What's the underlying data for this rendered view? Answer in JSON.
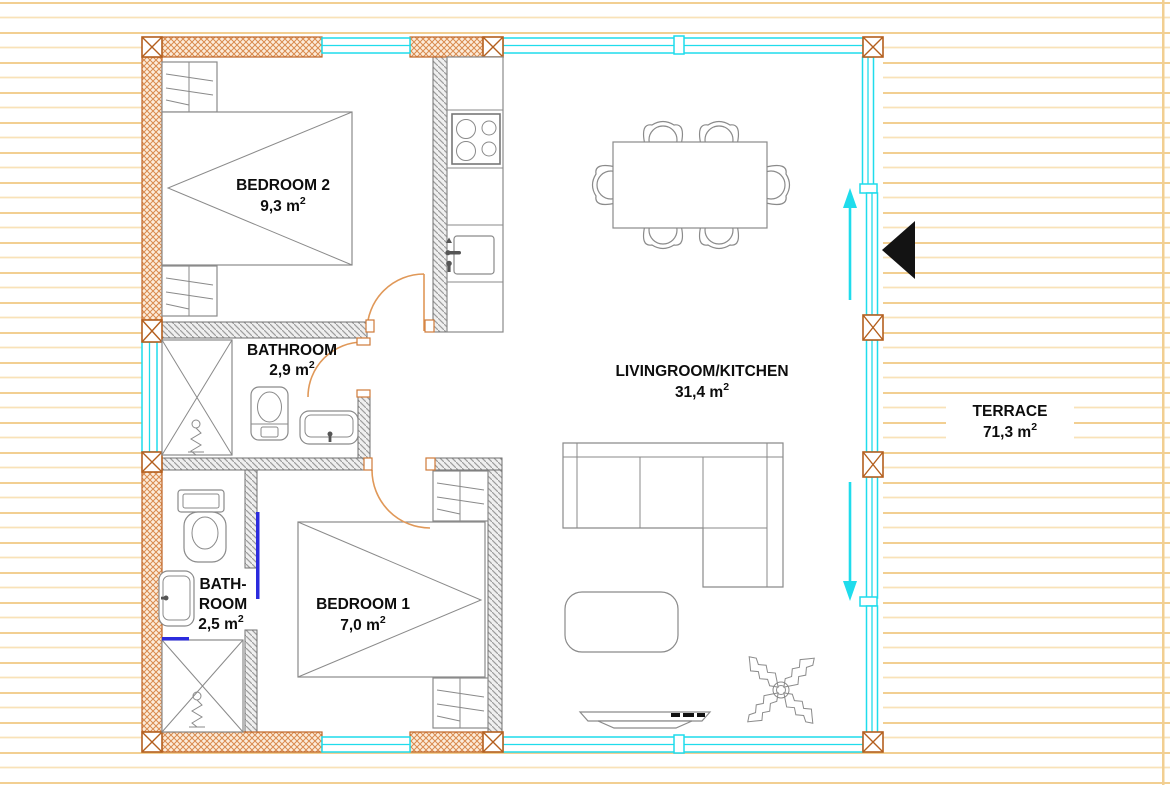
{
  "rooms": {
    "bedroom2": {
      "label": "BEDROOM 2",
      "area": "9,3 m",
      "area_sup": "2"
    },
    "bathroom1": {
      "label": "BATHROOM",
      "area": "2,9 m",
      "area_sup": "2"
    },
    "bathroom2": {
      "label_line1": "BATH-",
      "label_line2": "ROOM",
      "area": "2,5 m",
      "area_sup": "2"
    },
    "bedroom1": {
      "label": "BEDROOM 1",
      "area": "7,0 m",
      "area_sup": "2"
    },
    "livingroom": {
      "label": "LIVINGROOM/KITCHEN",
      "area": "31,4 m",
      "area_sup": "2"
    },
    "terrace": {
      "label": "TERRACE",
      "area": "71,3 m",
      "area_sup": "2"
    }
  },
  "colors": {
    "glass_cyan": "#1fdcec",
    "exterior_wall_orange": "#bf6527",
    "exterior_wall_fill": "#fcecdb",
    "interior_wall_gray": "#9c9c9c",
    "door_swing_orange": "#e09858",
    "deck_line_orange": "#f2cf92",
    "sliding_marker_blue": "#2b2bdd",
    "entrance_marker_black": "#131313",
    "furniture_gray": "#8a8a8a",
    "label_black": "#0d0d0d"
  }
}
